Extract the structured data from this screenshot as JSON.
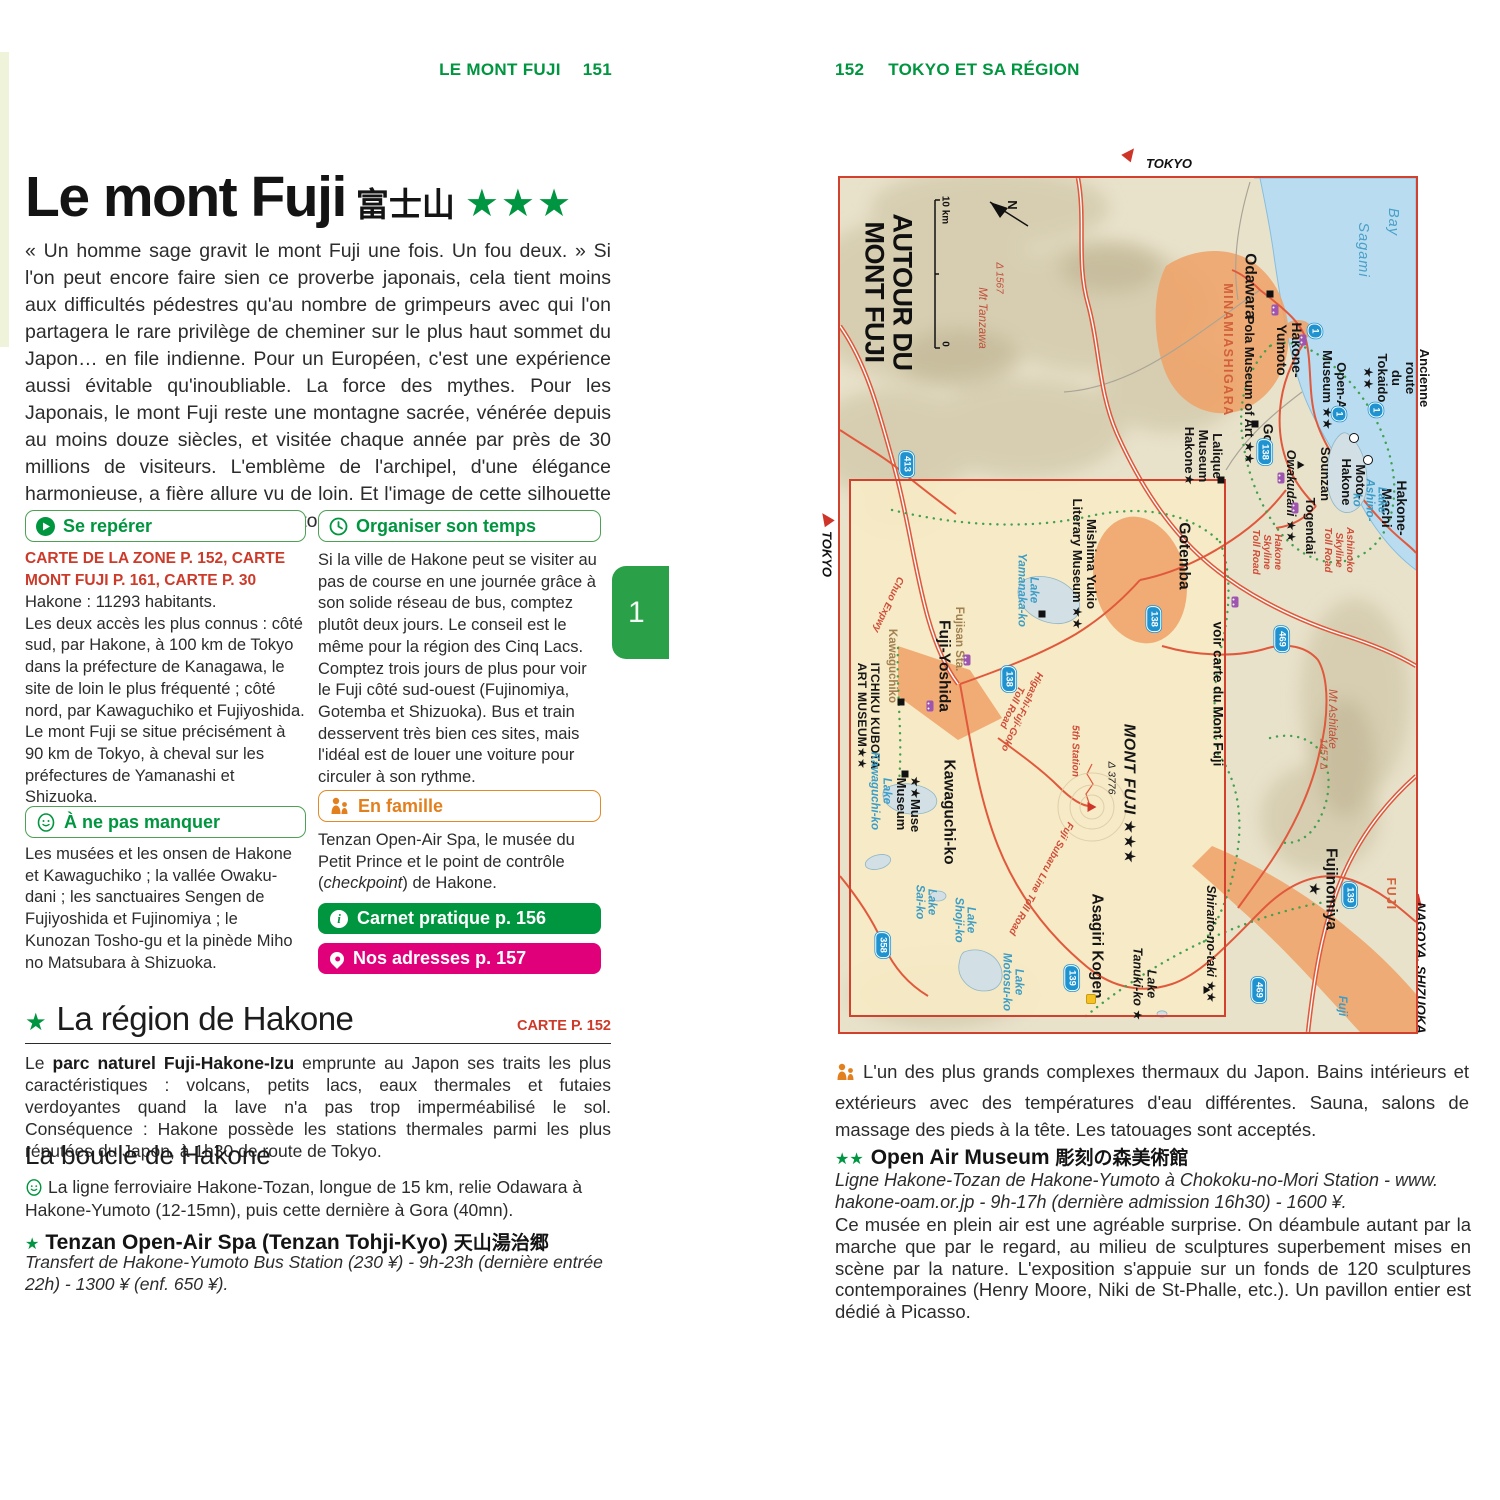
{
  "colors": {
    "brand_green": "#00953f",
    "red_text": "#cc3a2a",
    "pink": "#e0007a",
    "orange": "#e2801f",
    "map_border": "#d2402e",
    "route_badge_blue": "#1f93d0"
  },
  "page_left": {
    "header": {
      "title": "LE MONT FUJI",
      "page": "151"
    },
    "title": {
      "main": "Le mont Fuji",
      "jp": "富士山",
      "stars": "★★★"
    },
    "intro": "« Un homme sage gravit le mont Fuji une fois. Un fou deux. » Si l'on peut encore faire sien ce proverbe japonais, cela tient moins aux difficultés pédestres qu'au nombre de grimpeurs avec qui l'on partagera le rare privilège de cheminer sur le plus haut sommet du Japon… en file indienne. Pour un Européen, c'est une expérience aussi évitable qu'inoubliable. La force des mythes. Pour les Japonais, le mont Fuji reste une montagne sacrée, vénérée depuis au moins douze siècles, et visitée chaque année par près de 30 millions de visiteurs. L'emblème de l'archipel, d'une élégance harmonieuse, a fière allure vu de loin. Et l'image de cette silhouette singulière n'est pas près de s'estomper.",
    "se_reperer": {
      "title": "Se repérer",
      "maps": "CARTE DE LA ZONE P. 152, CARTE MONT FUJI P. 161, CARTE P. 30",
      "body": "Hakone : 11293 habitants.\nLes deux accès les plus connus : côté sud, par Hakone, à 100 km de Tokyo dans la préfecture de Kanagawa, le site de loin le plus fréquenté ; côté nord, par Kawaguchiko et Fujiyoshida. Le mont Fuji se situe précisément à 90 km de Tokyo, à cheval sur les préfectures de Yamanashi et Shizuoka."
    },
    "organiser": {
      "title": "Organiser son temps",
      "body": "Si la ville de Hakone peut se visiter au pas de course en une journée grâce à son solide réseau de bus, comptez plutôt deux jours. Le conseil est le même pour la région des Cinq Lacs. Comptez trois jours de plus pour voir le Fuji côté sud-ouest (Fujinomiya, Gotemba et Shizuoka). Bus et train desservent très bien ces sites, mais l'idéal est de louer une voiture pour circuler à son rythme."
    },
    "manquer": {
      "title": "À ne pas manquer",
      "body": "Les musées et les onsen de Hakone et Kawaguchiko ; la vallée Owaku-dani ; les sanctuaires Sengen de Fujiyoshida et Fujinomiya ; le Kunozan Tosho-gu et la pinède Miho no Matsubara à Shizuoka."
    },
    "famille": {
      "title": "En famille",
      "body_pre": "Tenzan Open-Air Spa, le musée du Petit Prince et le point de contrôle (",
      "body_italic": "checkpoint",
      "body_post": ") de Hakone."
    },
    "btn_carnet": "Carnet pratique p. 156",
    "btn_adresses": "Nos adresses p. 157",
    "tab": "1",
    "region": {
      "star": "★",
      "title": "La région de Hakone",
      "carte": "CARTE P. 152",
      "para_pre": "Le ",
      "para_bold": "parc naturel Fuji-Hakone-Izu",
      "para_post": " emprunte au Japon ses traits les plus caractéristiques : volcans, petits lacs, eaux thermales et futaies verdoyantes quand la lave n'a pas trop imperméabilisé le sol. Conséquence : Hakone possède les stations thermales parmi les plus réputées du Japon, à 1h30 de route de Tokyo."
    },
    "boucle": {
      "title": "La boucle de Hakone",
      "body": "La ligne ferroviaire Hakone-Tozan, longue de 15 km, relie Odawara à Hakone-Yumoto (12-15mn), puis cette dernière à Gora (40mn)."
    },
    "tenzan": {
      "star": "★",
      "title": "Tenzan Open-Air Spa (Tenzan Tohji-Kyo)",
      "jp": "天山湯治郷",
      "info": "Transfert de Hakone-Yumoto Bus Station (230 ¥) - 9h-23h (dernière entrée 22h) - 1300 ¥ (enf. 650 ¥)."
    }
  },
  "page_right": {
    "header": {
      "page": "152",
      "title": "TOKYO ET SA RÉGION"
    },
    "map": {
      "top_dest": "TOKYO",
      "left_dest": "TOKYO",
      "bottom_dest": "NAGOYA, SHIZUOKA",
      "route1_label": "1",
      "labels": [
        {
          "t": "AUTOUR DU\nMONT FUJI",
          "c": "title",
          "x": 48,
          "y": 114
        },
        {
          "t": "10 km",
          "c": "scale",
          "x": 104,
          "y": 32
        },
        {
          "t": "0",
          "c": "scale",
          "x": 104,
          "y": 166
        },
        {
          "t": "N",
          "c": "north",
          "x": 172,
          "y": 27
        },
        {
          "t": "Mt Tanzawa",
          "c": "mtn",
          "x": 142,
          "y": 140
        },
        {
          "t": "Δ 1567",
          "c": "mtn-sm",
          "x": 158,
          "y": 100
        },
        {
          "t": "Odawara",
          "c": "town-lg",
          "x": 409,
          "y": 108
        },
        {
          "t": "MINAMIASHIGARA",
          "c": "area",
          "x": 387,
          "y": 172
        },
        {
          "t": "Sagami",
          "c": "sea",
          "x": 522,
          "y": 72
        },
        {
          "t": "Bay",
          "c": "sea",
          "x": 552,
          "y": 44
        },
        {
          "t": "Pola Museum of Art ★★",
          "c": "poi",
          "x": 409,
          "y": 212
        },
        {
          "t": "Hakone-\nYumoto",
          "c": "town",
          "x": 449,
          "y": 172
        },
        {
          "t": "Gora",
          "c": "town",
          "x": 428,
          "y": 262
        },
        {
          "t": "Open-Air Museum ★★",
          "c": "poi",
          "x": 494,
          "y": 212
        },
        {
          "t": "Lalique\nMuseum\nHakone★",
          "c": "poi",
          "x": 363,
          "y": 278
        },
        {
          "t": "Owakudani ★★",
          "c": "ital",
          "x": 450,
          "y": 318
        },
        {
          "t": "Sounzan",
          "c": "poi",
          "x": 485,
          "y": 296
        },
        {
          "t": "Togendai",
          "c": "poi",
          "x": 470,
          "y": 348
        },
        {
          "t": "Moto-\nHakone",
          "c": "poi",
          "x": 513,
          "y": 304
        },
        {
          "t": "Hakone-Machi",
          "c": "town",
          "x": 554,
          "y": 330
        },
        {
          "t": "Lake\nAshino-ko",
          "c": "water",
          "x": 529,
          "y": 322
        },
        {
          "t": "Ancienne route\ndu Tokaido ★★",
          "c": "poi",
          "x": 556,
          "y": 200
        },
        {
          "t": "Ashinoko\nSkyline\nToll Road",
          "c": "toll",
          "x": 498,
          "y": 372
        },
        {
          "t": "Hakone\nSkyline\nToll Road",
          "c": "toll",
          "x": 426,
          "y": 374
        },
        {
          "t": "Gotemba",
          "c": "town-lg",
          "x": 343,
          "y": 378
        },
        {
          "t": "voir carte du Mont Fuji",
          "c": "note",
          "x": 377,
          "y": 516
        },
        {
          "t": "Mishima Yukio\nLiterary Museum ★★",
          "c": "poi",
          "x": 244,
          "y": 386
        },
        {
          "t": "Lake\nYamanaka-ko",
          "c": "water",
          "x": 187,
          "y": 412
        },
        {
          "t": "Chuo Expwy",
          "c": "toll",
          "x": 47,
          "y": 426,
          "r": 115
        },
        {
          "t": "Kawaguchiko",
          "c": "sepia",
          "x": 52,
          "y": 488
        },
        {
          "t": "Fujisan Sta.",
          "c": "sepia",
          "x": 119,
          "y": 461
        },
        {
          "t": "Fuji-Yoshida",
          "c": "town-lg",
          "x": 103,
          "y": 488
        },
        {
          "t": "ITCHIKU KUBOTA\nART MUSEUM★★",
          "c": "poi-caps",
          "x": 28,
          "y": 538
        },
        {
          "t": "Higashi-Fuji-Goko\nToll Road",
          "c": "toll",
          "x": 176,
          "y": 531,
          "r": 115
        },
        {
          "t": "★★Muse\nMuseum",
          "c": "poi",
          "x": 68,
          "y": 626
        },
        {
          "t": "Kawaguchi-ko",
          "c": "town-lg",
          "x": 108,
          "y": 634
        },
        {
          "t": "Lake\nKawaguchi-ko",
          "c": "water",
          "x": 40,
          "y": 613
        },
        {
          "t": "MONT FUJI ★★★",
          "c": "big",
          "x": 289,
          "y": 616
        },
        {
          "t": "Δ 3776",
          "c": "ital-sm",
          "x": 271,
          "y": 600
        },
        {
          "t": "5th Station",
          "c": "toll",
          "x": 234,
          "y": 573
        },
        {
          "t": "Fuji Subaru Line Toll Road",
          "c": "toll",
          "x": 200,
          "y": 700,
          "r": 118
        },
        {
          "t": "Lake\nSai-ko",
          "c": "water",
          "x": 85,
          "y": 724
        },
        {
          "t": "Lake\nShoji-ko",
          "c": "water",
          "x": 124,
          "y": 742
        },
        {
          "t": "Lake\nMotosu-ko",
          "c": "water",
          "x": 172,
          "y": 804
        },
        {
          "t": "Asagiri Kogen",
          "c": "town-lg",
          "x": 256,
          "y": 768
        },
        {
          "t": "Lake\nTanuki-ko ★",
          "c": "ital",
          "x": 304,
          "y": 806
        },
        {
          "t": "Shiraito-no-taki ★★",
          "c": "ital",
          "x": 370,
          "y": 766
        },
        {
          "t": "Fujinomiya ★",
          "c": "town-lg",
          "x": 482,
          "y": 711
        },
        {
          "t": "FUJI",
          "c": "area",
          "x": 550,
          "y": 716
        },
        {
          "t": "Fuji",
          "c": "water",
          "x": 502,
          "y": 828
        },
        {
          "t": "Mt Ashitake",
          "c": "mtn",
          "x": 492,
          "y": 541
        },
        {
          "t": "1457 Δ",
          "c": "mtn-sm",
          "x": 482,
          "y": 576
        }
      ],
      "badges": [
        {
          "n": "413",
          "x": 67,
          "y": 286
        },
        {
          "n": "138",
          "x": 169,
          "y": 501
        },
        {
          "n": "138",
          "x": 314,
          "y": 441
        },
        {
          "n": "138",
          "x": 425,
          "y": 274
        },
        {
          "n": "139",
          "x": 232,
          "y": 800
        },
        {
          "n": "139",
          "x": 510,
          "y": 717
        },
        {
          "n": "358",
          "x": 43,
          "y": 767
        },
        {
          "n": "469",
          "x": 442,
          "y": 461
        },
        {
          "n": "469",
          "x": 419,
          "y": 812
        }
      ],
      "route1": [
        {
          "x": 475,
          "y": 153
        },
        {
          "x": 499,
          "y": 236
        },
        {
          "x": 536,
          "y": 232
        }
      ],
      "markers": [
        {
          "t": "sq",
          "x": 415,
          "y": 246
        },
        {
          "t": "sq",
          "x": 381,
          "y": 302
        },
        {
          "t": "sq",
          "x": 202,
          "y": 436
        },
        {
          "t": "sq",
          "x": 61,
          "y": 524
        },
        {
          "t": "sq",
          "x": 65,
          "y": 596
        },
        {
          "t": "sq",
          "x": 430,
          "y": 116
        },
        {
          "t": "circ",
          "x": 514,
          "y": 260
        },
        {
          "t": "circ",
          "x": 528,
          "y": 282
        },
        {
          "t": "tri",
          "x": 461,
          "y": 287
        },
        {
          "t": "tri",
          "x": 367,
          "y": 812
        },
        {
          "t": "trired",
          "x": 252,
          "y": 629
        },
        {
          "t": "train",
          "x": 435,
          "y": 132
        },
        {
          "t": "train",
          "x": 463,
          "y": 162
        },
        {
          "t": "train",
          "x": 441,
          "y": 300
        },
        {
          "t": "train",
          "x": 455,
          "y": 330
        },
        {
          "t": "train",
          "x": 127,
          "y": 482
        },
        {
          "t": "train",
          "x": 90,
          "y": 528
        },
        {
          "t": "train",
          "x": 395,
          "y": 424
        },
        {
          "t": "torii",
          "x": 251,
          "y": 821
        }
      ]
    },
    "famille_para": "L'un des plus grands complexes thermaux du Japon. Bains intérieurs et extérieurs avec des températures d'eau différentes. Sauna, salons de massage des pieds à la tête. Les tatouages sont acceptés.",
    "open_air": {
      "stars": "★★",
      "title": "Open Air Museum",
      "jp": "彫刻の森美術館",
      "info": "Ligne Hakone-Tozan de Hakone-Yumoto à Chokoku-no-Mori Station - www. hakone-oam.or.jp - 9h-17h (dernière admission 16h30) - 1600 ¥.",
      "body": "Ce musée en plein air est une agréable surprise. On déambule autant par la marche que par le regard, au milieu de sculptures superbement mises en scène par la nature. L'exposition s'appuie sur un fonds de 120 sculptures contemporaines (Henry Moore, Niki de St-Phalle, etc.). Un pavillon entier est dédié à Picasso."
    }
  }
}
